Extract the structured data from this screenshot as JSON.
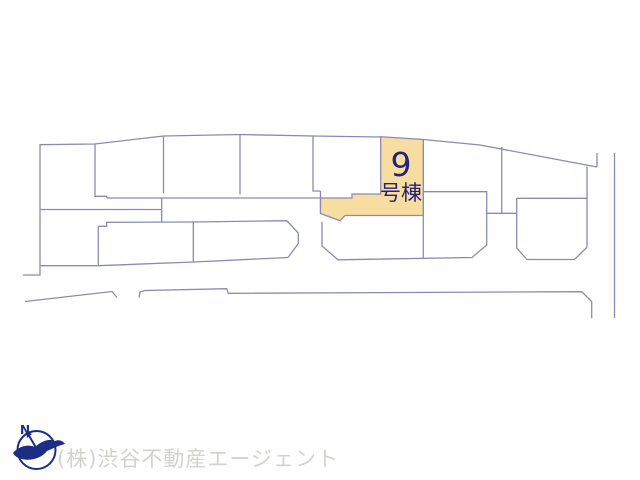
{
  "map": {
    "highlight": {
      "number": "9",
      "suffix": "号棟"
    },
    "colors": {
      "line": "#8a8ab5",
      "highlight_fill": "#f8dda0",
      "highlight_text": "#232377",
      "watermark_text": "#d3d3ce",
      "compass": "#1c2d86"
    }
  },
  "footer": {
    "compass_label": "N",
    "company": "(株)渋谷不動産エージェント"
  }
}
